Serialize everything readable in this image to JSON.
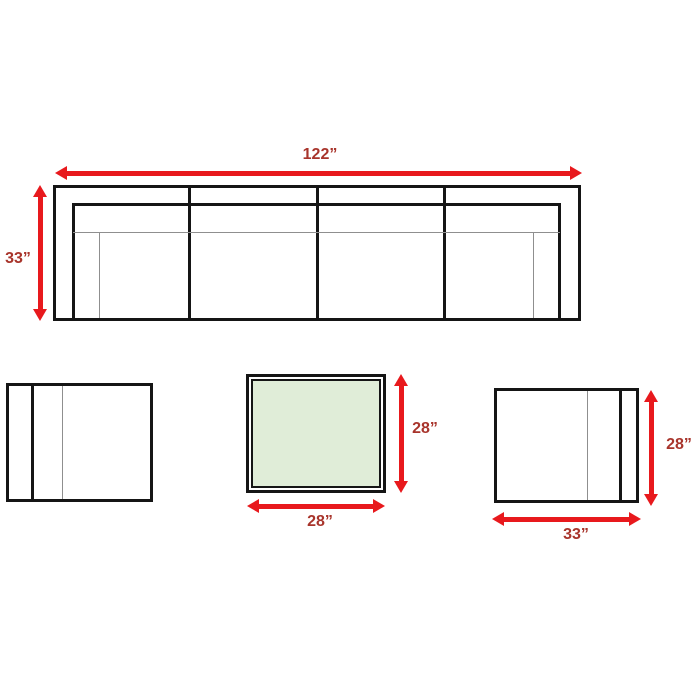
{
  "diagram": {
    "sofa": {
      "width_label": "122”",
      "height_label": "33”"
    },
    "coffee_table": {
      "width_label": "28”",
      "height_label": "28”"
    },
    "armchair_right": {
      "width_label": "33”",
      "height_label": "28”"
    }
  },
  "colors": {
    "arrow_red": "#e8191d",
    "label_red": "#a8342b",
    "outline_black": "#151515",
    "thin_gray": "#8f8f8f",
    "table_top_green": "#e0edd8",
    "background": "#ffffff"
  }
}
